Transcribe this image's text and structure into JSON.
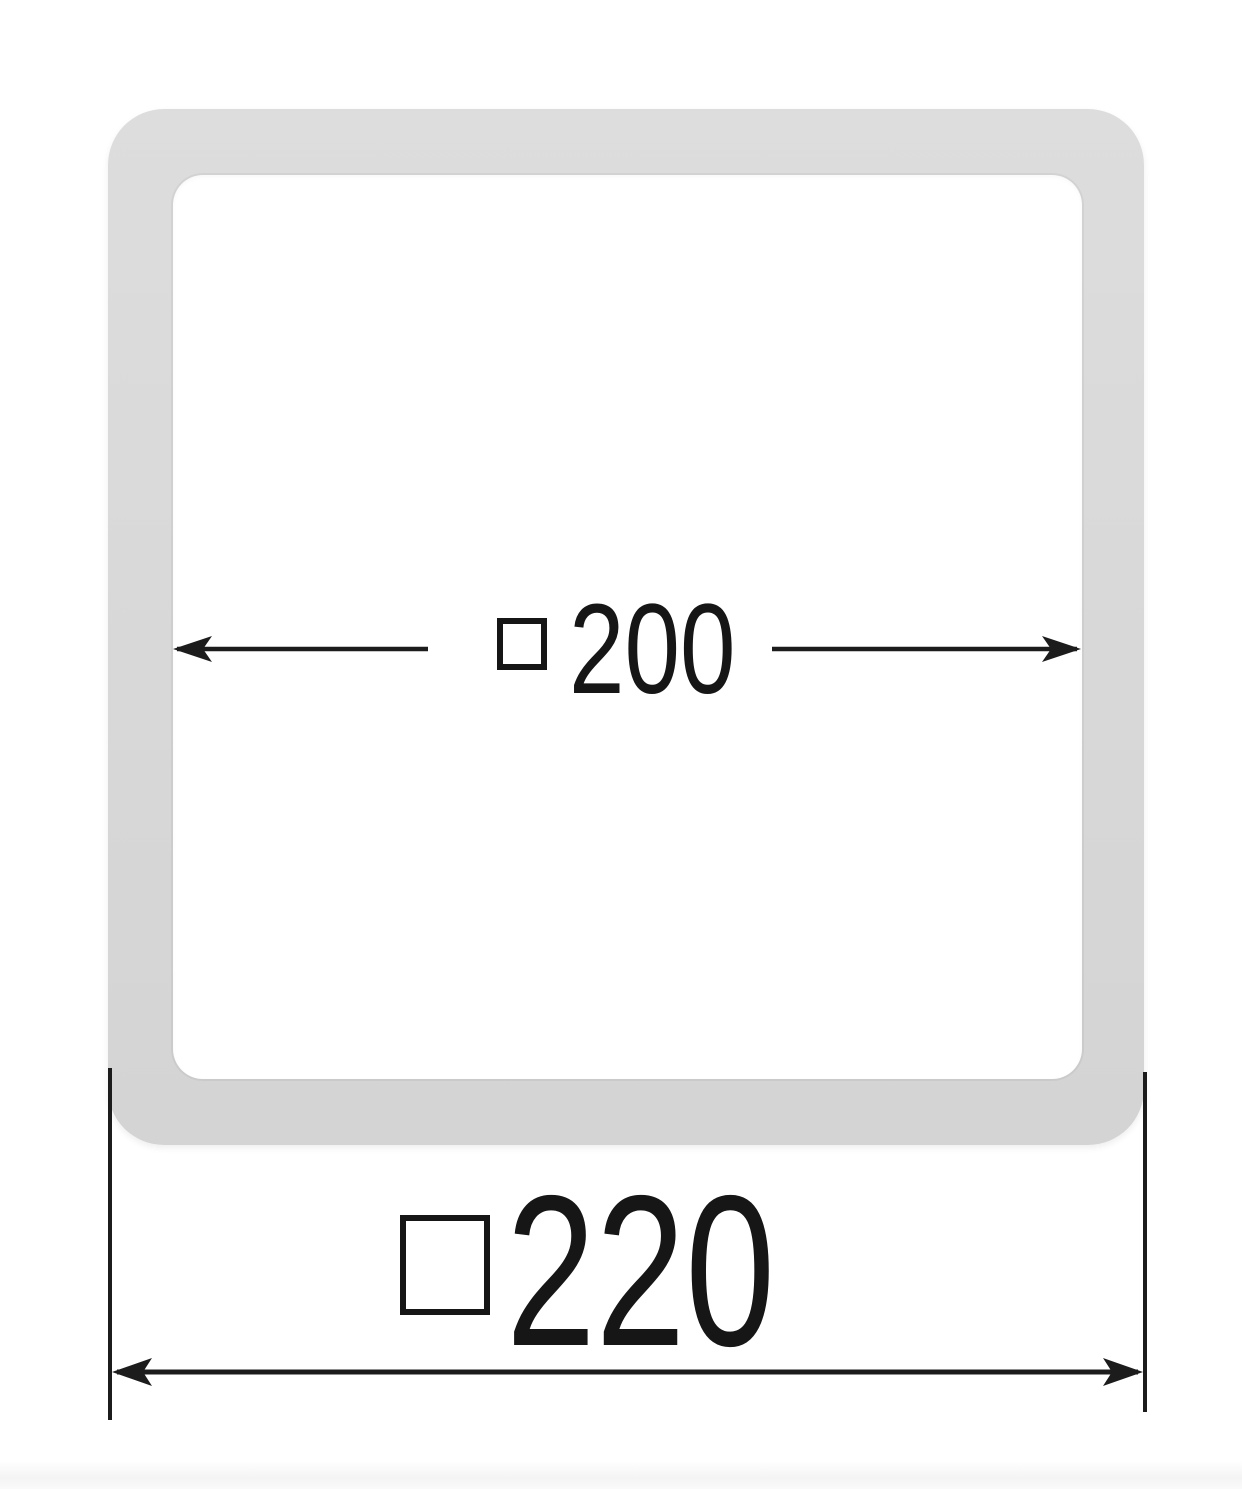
{
  "diagram": {
    "type": "technical-dimension-drawing",
    "subject": "square-profile-cross-section",
    "colors": {
      "background": "#ffffff",
      "profile_fill": "#d9d9d9",
      "dimension_line": "#1c1c1c",
      "text": "#161616"
    },
    "inner_dimension": {
      "symbol": "square",
      "symbol_glyph": "□",
      "value": "200"
    },
    "outer_dimension": {
      "symbol": "square",
      "symbol_glyph": "□",
      "value": "220"
    }
  }
}
